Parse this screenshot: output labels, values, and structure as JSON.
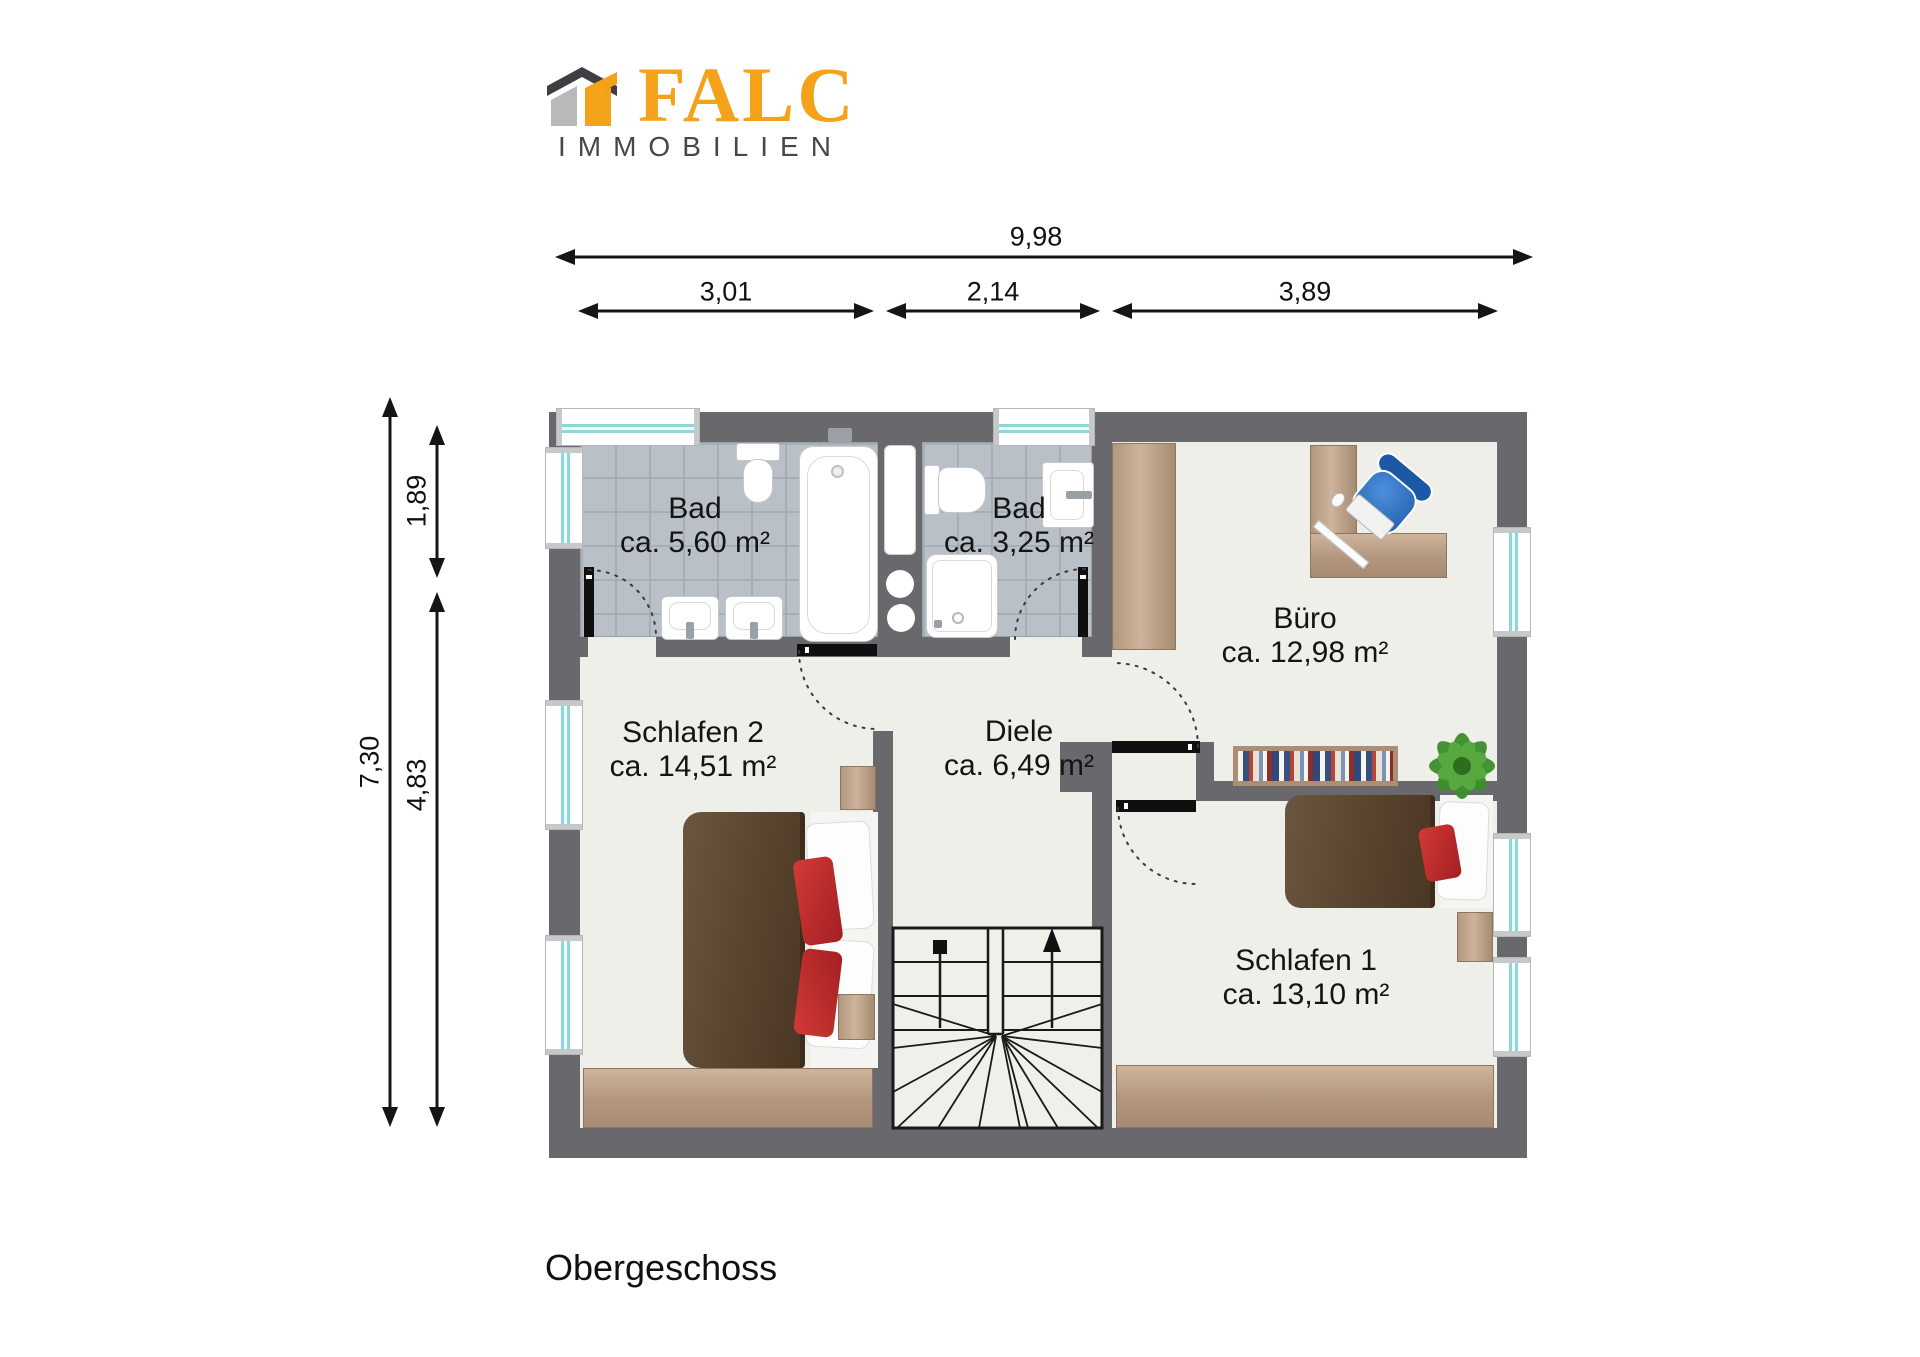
{
  "brand": {
    "name": "FALC",
    "subtitle": "IMMOBILIEN"
  },
  "floor_title": "Obergeschoss",
  "dims": {
    "total_width": "9,98",
    "seg_left": "3,01",
    "seg_mid": "2,14",
    "seg_right": "3,89",
    "total_height": "7,30",
    "seg_top": "1,89",
    "seg_bottom": "4,83"
  },
  "rooms": {
    "bad1": {
      "name": "Bad",
      "area": "ca. 5,60 m²"
    },
    "bad2": {
      "name": "Bad",
      "area": "ca. 3,25 m²"
    },
    "buero": {
      "name": "Büro",
      "area": "ca. 12,98 m²"
    },
    "schlafen2": {
      "name": "Schlafen 2",
      "area": "ca. 14,51 m²"
    },
    "diele": {
      "name": "Diele",
      "area": "ca. 6,49 m²"
    },
    "schlafen1": {
      "name": "Schlafen 1",
      "area": "ca. 13,10 m²"
    }
  },
  "colors": {
    "brand_orange": "#F4A219",
    "wall_gray": "#69686d",
    "floor": "#edefe8",
    "tile": "#bac0c7",
    "window_teal": "#8ed7d6",
    "bed_brown": "#5f4a34",
    "pillow_red": "#bf2b2e",
    "chair_blue": "#2f74c4",
    "plant_green": "#3d8e2d"
  }
}
